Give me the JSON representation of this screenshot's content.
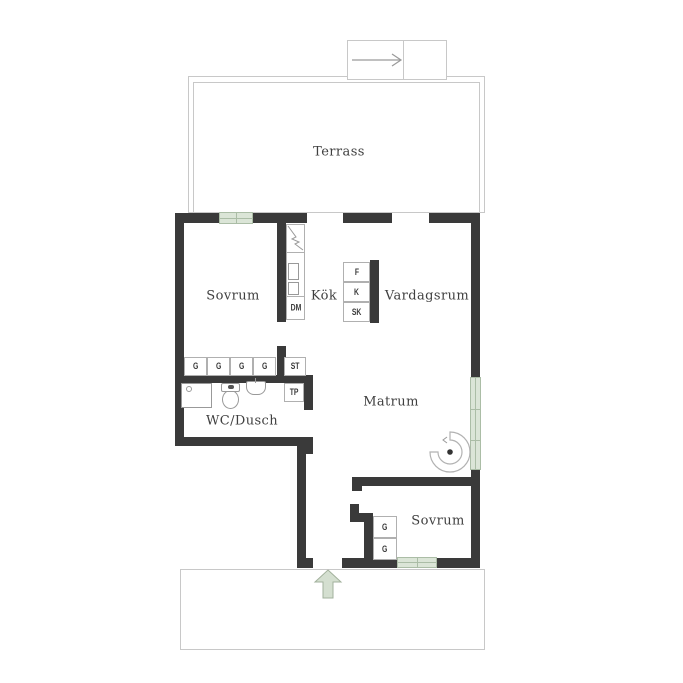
{
  "floorplan": {
    "rooms": {
      "terrace": "Terrass",
      "bedroom_top": "Sovrum",
      "kitchen": "Kök",
      "living_room": "Vardagsrum",
      "dining_room": "Matrum",
      "bathroom": "WC/Dusch",
      "bedroom_bottom": "Sovrum"
    },
    "appliances": {
      "dishwasher": "DM",
      "freezer": "F",
      "fridge": "K",
      "cabinet": "SK",
      "cleaning_cabinet": "ST",
      "drying_cabinet": "TP"
    },
    "wardrobes": {
      "hall": [
        "G",
        "G",
        "G",
        "G"
      ],
      "bedroom": [
        "G",
        "G"
      ]
    },
    "icons": {
      "entrance": "up-arrow",
      "stairs": "right-arrow",
      "door_swing": "pivot-arc",
      "shower": "square-with-drain",
      "toilet": "tank-and-bowl",
      "sink": "basin-with-tap",
      "tall_cabinet": "diagonal-zigzag"
    },
    "colors": {
      "wall": "#3a3a3a",
      "window_fill": "#dbe5d7",
      "window_frame": "#abbda6",
      "arrow_fill": "#d4dfd0",
      "arrow_outline": "#a2b19c",
      "outline": "#c8c8c8",
      "fixture_outline": "#999999",
      "text": "#3f3f3f"
    }
  }
}
